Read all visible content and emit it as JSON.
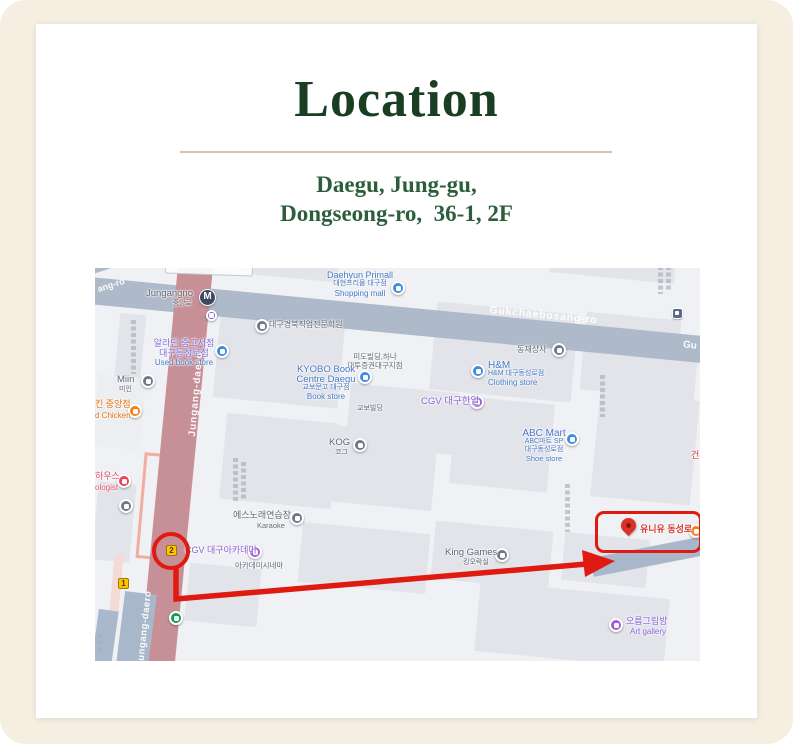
{
  "colors": {
    "background_beige": "#f5eee1",
    "card_white": "#ffffff",
    "title_green": "#1a3e22",
    "address_green": "#2d5e3c",
    "divider_tan": "#dcbcab",
    "annotation_red": "#e01a10",
    "poi_blue": "#4677c8",
    "poi_purple": "#8a5fd6",
    "road_rose": "#c78f96",
    "road_gray": "#aeb9ca"
  },
  "header": {
    "title": "Location",
    "address_line1": "Daegu, Jung-gu,",
    "address_line2": "Dongseong-ro,  36-1, 2F"
  },
  "map": {
    "station": {
      "name": "Jungangno",
      "korean": "중앙로",
      "symbol": "M"
    },
    "roads": {
      "jungang_daero": "Jungang-daero",
      "gukchaebosang_ro": "Gukchaebosang-ro",
      "gukchaebosang_partial": "Gu",
      "ang_ro": "ang-ro"
    },
    "exits": {
      "exit1": "1",
      "exit2": "2"
    },
    "destination": {
      "label": "유니유 동성로"
    },
    "pois": {
      "vocational_school": "대구경북직업전문학원",
      "aladin_line1": "알라딘 중고서점",
      "aladin_line2": "대구동성로점",
      "aladin_line3": "Used book store",
      "daehyun_line1": "Daehyun Primall",
      "daehyun_line2": "대현프리몰 대구점",
      "daehyun_line3": "Shopping mall",
      "mido_line1": "미도빌딩,하나",
      "mido_line2": "대투증권대구지점",
      "dongjae": "동재상사",
      "kyobo_line1": "KYOBO Book",
      "kyobo_line2": "Centre Daegu",
      "kyobo_line3": "교보문고 대구점",
      "kyobo_line4": "Book store",
      "kyobo_building": "교보빌딩",
      "hm_line1": "H&M",
      "hm_line2": "H&M 대구동성로점",
      "hm_line3": "Clothing store",
      "cgv_hanil": "CGV 대구한일",
      "abc_line1": "ABC Mart",
      "abc_line2": "ABC마트 SP",
      "abc_line3": "대구동성로점",
      "abc_line4": "Shoe store",
      "kog": "KOG",
      "kog_kr": "코그",
      "miin": "Miin",
      "miin_kr": "미인",
      "chicken_line1": "킨 중앙점",
      "chicken_line2": "d Chicken",
      "house_line1": "하우스",
      "house_line2": "ologist",
      "karaoke_line1": "에스노래연습장",
      "karaoke_line2": "Karaoke",
      "cgv_academy": "CGV 대구아카데미",
      "academy_cinema": "아카데미시네마",
      "king_games": "King Games",
      "king_games_kr": "킹오락실",
      "art_gallery_kr": "오름그림방",
      "art_gallery_en": "Art gallery",
      "geon": "건"
    }
  }
}
